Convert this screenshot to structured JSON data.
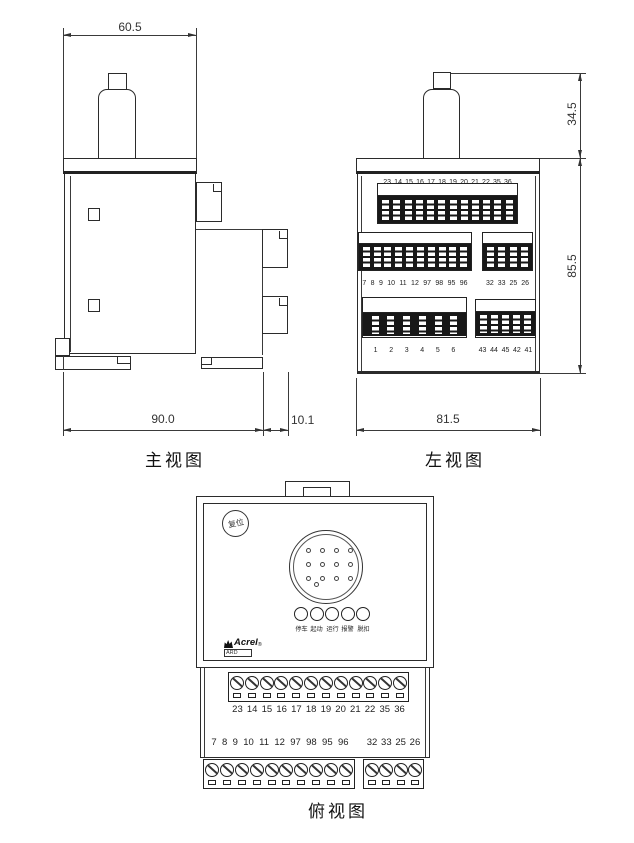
{
  "drawing": {
    "front_view": {
      "label": "主视图",
      "dim_top": "60.5",
      "dim_bottom": "90.0",
      "dim_terminal": "10.1"
    },
    "left_view": {
      "label": "左视图",
      "dim_knob": "34.5",
      "dim_height": "85.5",
      "dim_width": "81.5",
      "row1": [
        "23",
        "14",
        "15",
        "16",
        "17",
        "18",
        "19",
        "20",
        "21",
        "22",
        "35",
        "36"
      ],
      "row2_left": [
        "7",
        "8",
        "9",
        "10",
        "11",
        "12",
        "97",
        "98",
        "95",
        "96"
      ],
      "row2_right": [
        "32",
        "33",
        "25",
        "26"
      ],
      "row3_left": [
        "1",
        "2",
        "3",
        "4",
        "5",
        "6"
      ],
      "row3_right": [
        "43",
        "44",
        "45",
        "42",
        "41"
      ]
    },
    "top_view": {
      "label": "俯视图",
      "reset_button": "复位",
      "led_labels": [
        "停车",
        "起动",
        "运行",
        "报警",
        "脱扣"
      ],
      "brand": "Acrel",
      "brand_reg": "®",
      "model": "ARD",
      "strip1": [
        "23",
        "14",
        "15",
        "16",
        "17",
        "18",
        "19",
        "20",
        "21",
        "22",
        "35",
        "36"
      ],
      "strip2_left": [
        "7",
        "8",
        "9",
        "10",
        "11",
        "12",
        "97",
        "98",
        "95",
        "96"
      ],
      "strip2_right": [
        "32",
        "33",
        "25",
        "26"
      ]
    }
  }
}
